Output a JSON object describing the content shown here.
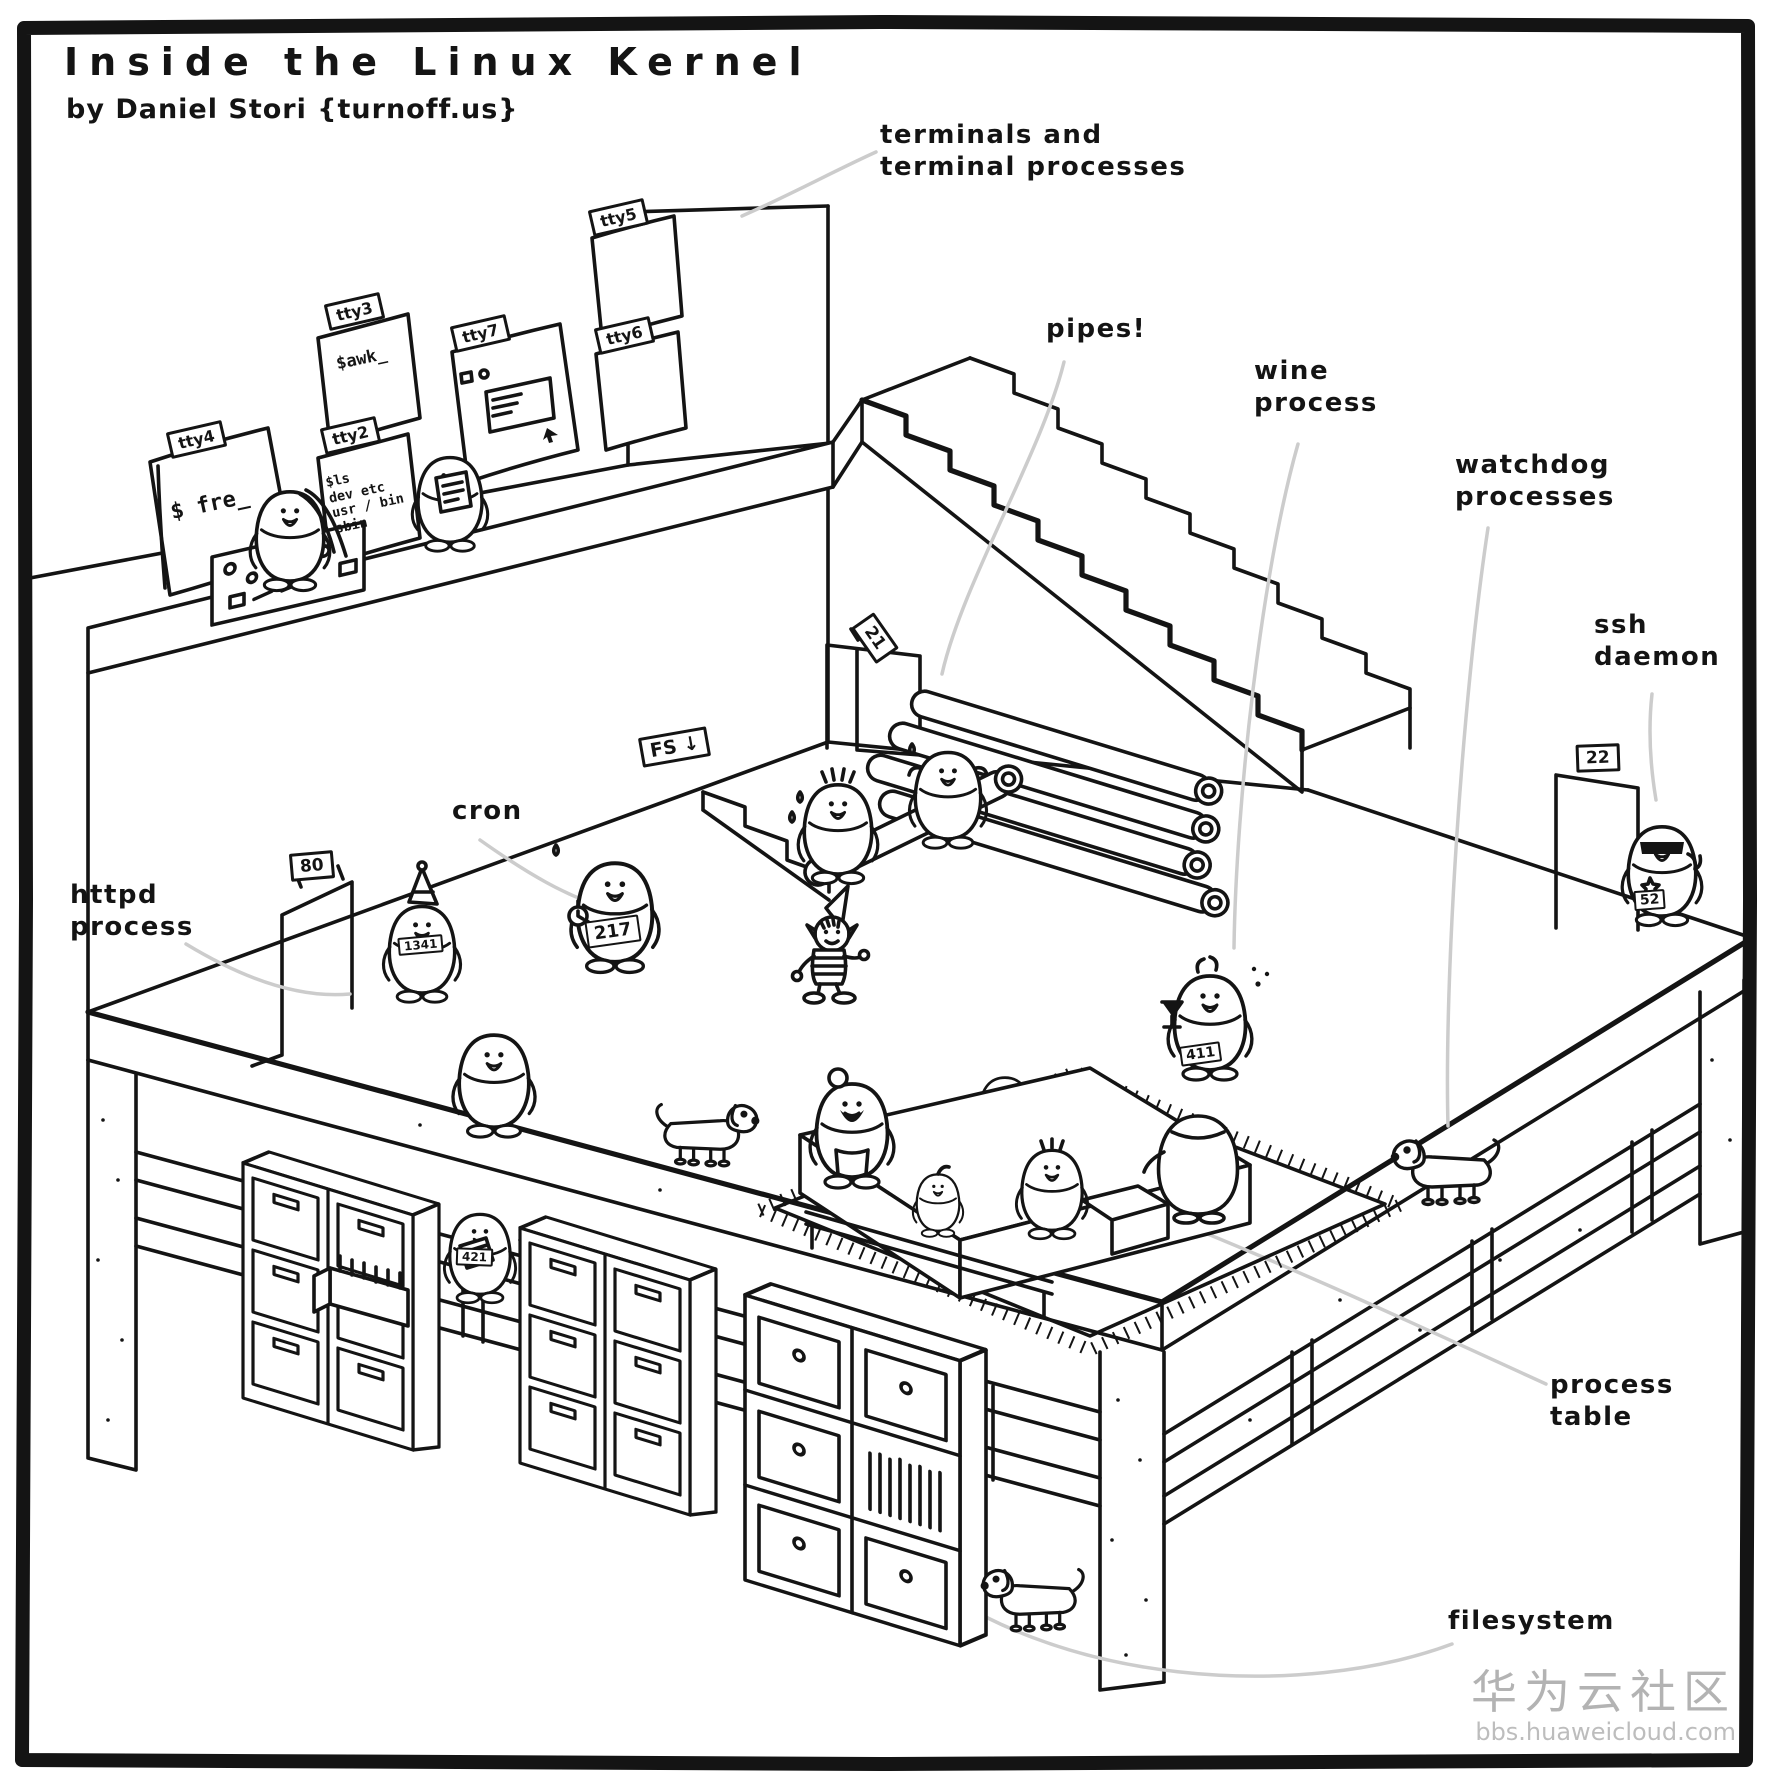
{
  "title": "Inside the Linux Kernel",
  "byline": "by Daniel Stori {turnoff.us}",
  "annotations": {
    "terminals": "terminals and\nterminal processes",
    "pipes": "pipes!",
    "wine": "wine\nprocess",
    "watchdog": "watchdog\nprocesses",
    "ssh": "ssh\ndaemon",
    "cron": "cron",
    "httpd": "httpd\nprocess",
    "process_table": "process\ntable",
    "filesystem": "filesystem"
  },
  "signs": {
    "fs_down": "FS ↓",
    "http_port": "80",
    "ftp_port": "21",
    "ssh_port": "22"
  },
  "terminals": {
    "tty2": {
      "label": "tty2",
      "screen": "$ls\ndev etc\nusr / bin\nsbin"
    },
    "tty3": {
      "label": "tty3",
      "screen": "$awk_"
    },
    "tty4": {
      "label": "tty4",
      "screen": "$ fre_"
    },
    "tty5": {
      "label": "tty5",
      "screen": ""
    },
    "tty6": {
      "label": "tty6",
      "screen": ""
    },
    "tty7": {
      "label": "tty7",
      "screen": ""
    }
  },
  "pids": {
    "cron": "217",
    "httpd": "1341",
    "wine": "411",
    "ssh": "52",
    "filesystem": "421"
  },
  "watermark": {
    "brand": "华为云社区",
    "site": "bbs.huaweicloud.com"
  },
  "colors": {
    "ink": "#141414",
    "leader_line": "#cccccc",
    "watermark": "#b3b3b3",
    "paper": "#ffffff"
  }
}
